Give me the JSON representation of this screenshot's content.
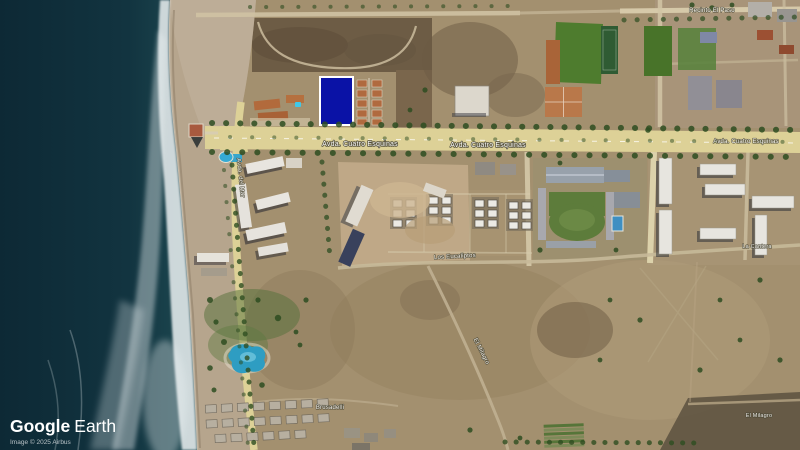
{
  "app": {
    "name": "Google Earth",
    "view": "satellite-imagery"
  },
  "attribution": {
    "brand": "Google",
    "product": "Earth",
    "credit": "Image © 2025 Airbus"
  },
  "map": {
    "type": "satellite",
    "scene": "coastal avenue with beach, surf, resort lots and a highlighted parcel",
    "labels": [
      {
        "id": "avenue-left",
        "text": "Avda. Cuatro Esquinas"
      },
      {
        "id": "avenue-center",
        "text": "Avda. Cuatro Esquinas"
      },
      {
        "id": "avenue-right",
        "text": "Avda. Cuatro Esquinas"
      },
      {
        "id": "coastal-road",
        "text": "Avda. del Mar"
      },
      {
        "id": "top-right-road",
        "text": "Recinto El Paso"
      },
      {
        "id": "center-track",
        "text": "Los Eucaliptos"
      },
      {
        "id": "diagonal-track",
        "text": "El Milagro"
      },
      {
        "id": "east-track",
        "text": "La Cantera"
      },
      {
        "id": "cabanas-row",
        "text": "Brusadelli"
      },
      {
        "id": "southeast-lot",
        "text": "El Milagro"
      }
    ],
    "highlight": {
      "name": "selected-parcel",
      "fill": "#0a12a6",
      "border": "#ffffff"
    },
    "colors": {
      "ocean": "#0d2935",
      "ocean_near": "#1e4a52",
      "surf": "#edf2f3",
      "sand": "#b6a58d",
      "land": "#a3906f",
      "scrub": "#6d5c45",
      "road_yellow": "#ddd197",
      "road_dirt": "#c7b999",
      "field_green": "#4e7c2e",
      "clay_court": "#b9784a",
      "tree": "#2e4d21",
      "pool": "#3aa6cc",
      "building_white": "#e7e5df"
    }
  }
}
